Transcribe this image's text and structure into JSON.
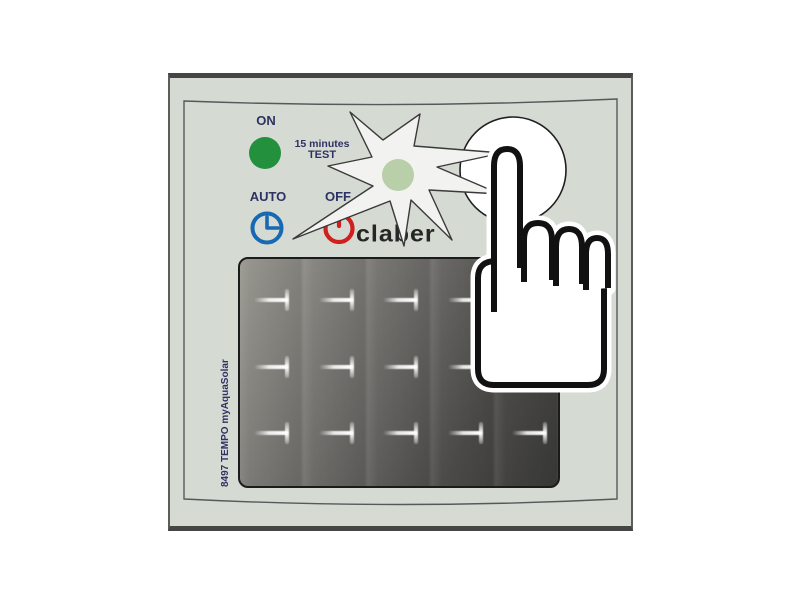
{
  "device": {
    "type_description": "irrigation timer front panel illustration",
    "brand_logo": "claber",
    "model_label": "8497 TEMPO myAquaSolar",
    "body_color": "#d5dad3",
    "controls": {
      "on": {
        "label": "ON",
        "led_color": "#23903d"
      },
      "test": {
        "line1": "15 minutes",
        "line2": "TEST"
      },
      "auto": {
        "label": "AUTO",
        "icon": "clock-icon",
        "color": "#1769b3"
      },
      "off": {
        "label": "OFF",
        "icon": "power-icon",
        "color": "#cf1f1f"
      }
    },
    "flash_indicator": {
      "icon": "led-flash-burst",
      "led_color": "#b8cfa9"
    },
    "test_button": {
      "shape": "circle",
      "fill": "#ffffff"
    },
    "hand_cursor": {
      "icon": "pointing-hand",
      "gesture": "pressing test button"
    },
    "solar_panel": {
      "rows": 3,
      "cols": 5
    }
  }
}
